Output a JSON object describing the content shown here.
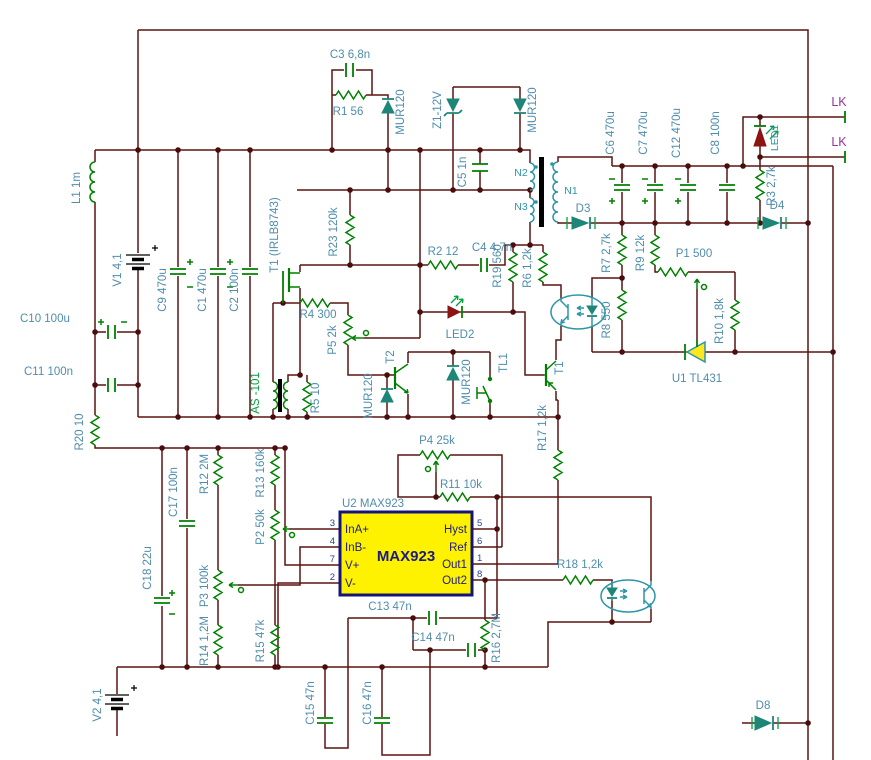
{
  "colors": {
    "background": "#ffffff",
    "wire": "#5b1412",
    "component_green": "#008000",
    "diode_teal": "#1d8677",
    "opto_teal": "#2e95a8",
    "label_blue": "#4f8dab",
    "label_green": "#00a23f",
    "label_purple": "#993399",
    "led_red": "#8e1313",
    "chip_fill": "#fff200",
    "chip_border": "#14147a",
    "tl431_fill": "#ffe81a"
  },
  "labels": {
    "c3": "C3 6,8n",
    "r1": "R1 56",
    "d1": "MUR120",
    "z1": "Z1-12V",
    "d2": "MUR120",
    "c5": "C5 1n",
    "n2": "N2",
    "n3": "N3",
    "n1": "N1",
    "d3": "D3",
    "c6": "C6 470u",
    "c7": "C7 470u",
    "c12": "C12 470u",
    "c8": "C8 100n",
    "led1": "LED1",
    "lk1": "LK",
    "lk2": "LK",
    "r3": "R3 2,7k",
    "d4": "D4",
    "l1": "L1 1m",
    "v1": "V1 4,1",
    "c9": "C9 470u",
    "c1": "C1 470u",
    "c2": "C2 100n",
    "c10": "C10 100u",
    "c11": "C11 100n",
    "t1m": "T1 (IRLB8743)",
    "r23": "R23 120k",
    "r2": "R2 12",
    "c4": "C4 4,7n",
    "r19": "R19 560",
    "r6": "R6 1,2k",
    "r4": "R4 300",
    "p5": "P5 2k",
    "r5": "R5 10",
    "as101": "AS -101",
    "d5": "MUR120",
    "d6": "MUR120",
    "t2": "T2",
    "led2": "LED2",
    "tl1": "TL1",
    "t1p": "T1",
    "r17": "R17 1,2k",
    "r7": "R7 2,7k",
    "r8": "R8 550",
    "r9": "R9 12k",
    "p1": "P1 500",
    "r10": "R10 1,8k",
    "u1": "U1 TL431",
    "r20": "R20 10",
    "c17": "C17 100n",
    "r12": "R12 2M",
    "r13": "R13 160k",
    "p2": "P2 50k",
    "c18": "C18 22u",
    "p3": "P3 100k",
    "r14": "R14 1,2M",
    "r15": "R15 47k",
    "v2": "V2 4,1",
    "p4": "P4 25k",
    "r11": "R11 10k",
    "c13": "C13 47n",
    "c14": "C14 47n",
    "c15": "C15 47n",
    "c16": "C16 47n",
    "r16": "R16 2,7M",
    "r18": "R18 1,2k",
    "d8": "D8"
  },
  "chip": {
    "ref": "U2 MAX923",
    "part": "MAX923",
    "pins_left": [
      {
        "n": "3",
        "label": "InA+"
      },
      {
        "n": "4",
        "label": "InB-"
      },
      {
        "n": "7",
        "label": "V+"
      },
      {
        "n": "2",
        "label": "V-"
      }
    ],
    "pins_right": [
      {
        "n": "5",
        "label": "Hyst"
      },
      {
        "n": "6",
        "label": "Ref"
      },
      {
        "n": "1",
        "label": "Out1"
      },
      {
        "n": "8",
        "label": "Out2"
      }
    ]
  }
}
